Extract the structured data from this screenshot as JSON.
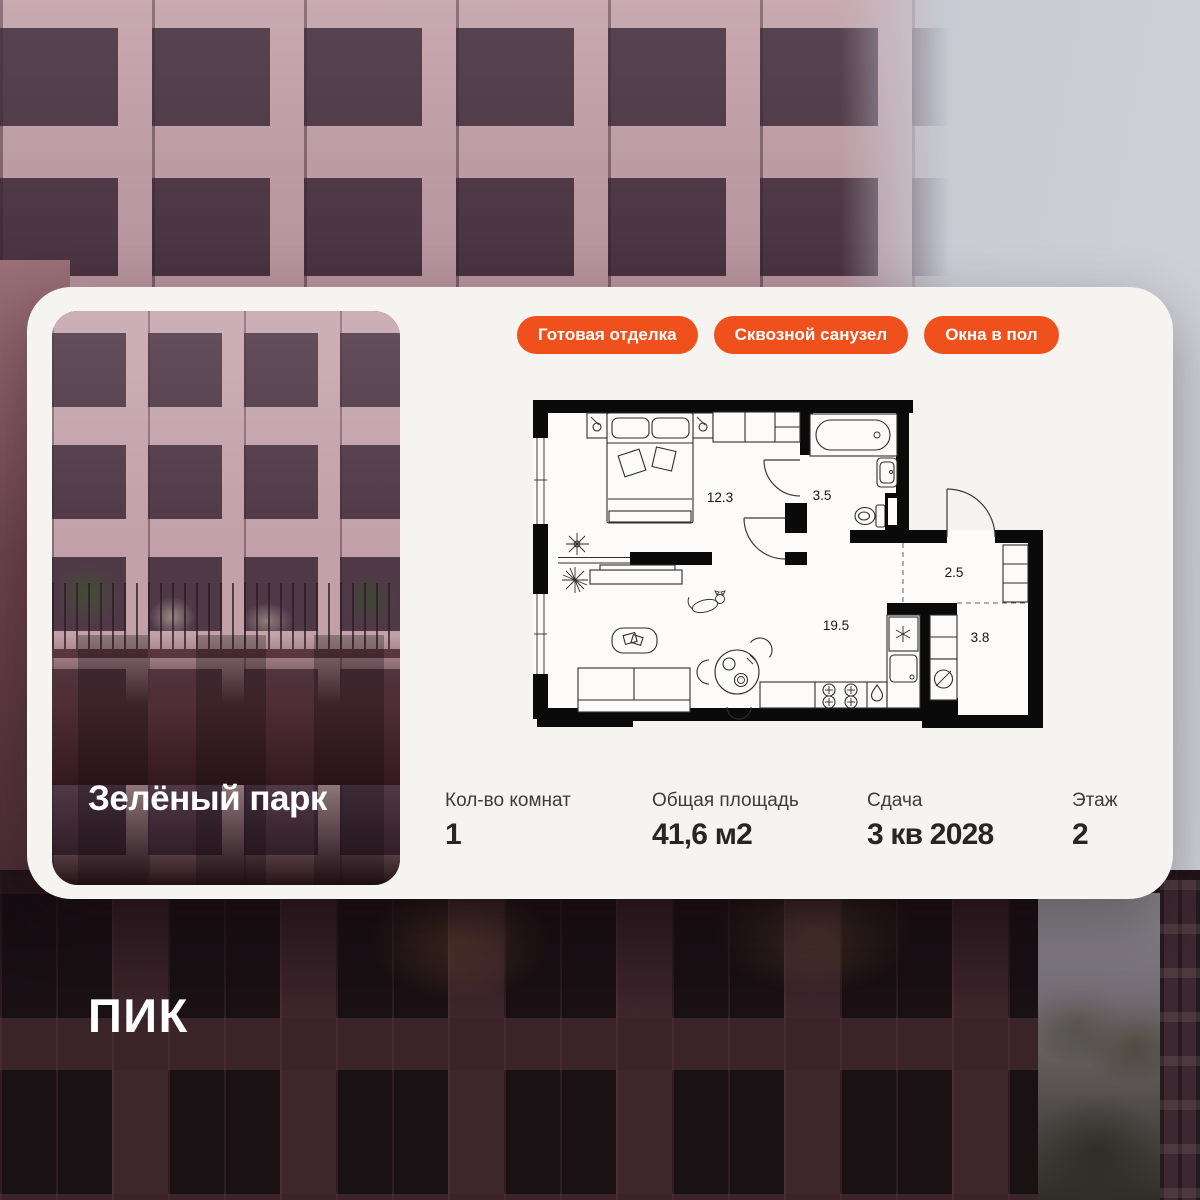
{
  "project": {
    "name": "Зелёный парк",
    "developer": "ПИК"
  },
  "badges": [
    {
      "label": "Готовая отделка"
    },
    {
      "label": "Сквозной санузел"
    },
    {
      "label": "Окна в пол"
    }
  ],
  "floorplan": {
    "rooms": [
      {
        "name": "bedroom",
        "area": "12.3"
      },
      {
        "name": "bathroom",
        "area": "3.5"
      },
      {
        "name": "hallway",
        "area": "2.5"
      },
      {
        "name": "living-kitchen",
        "area": "19.5"
      },
      {
        "name": "laundry",
        "area": "3.8"
      }
    ]
  },
  "stats": [
    {
      "label": "Кол-во комнат",
      "value": "1"
    },
    {
      "label": "Общая площадь",
      "value": "41,6 м2"
    },
    {
      "label": "Сдача",
      "value": "3 кв 2028"
    },
    {
      "label": "Этаж",
      "value": "2"
    }
  ],
  "colors": {
    "badge_orange": "#F0511C",
    "card_bg": "#F6F4F1",
    "wall_black": "#0A0A0A"
  }
}
